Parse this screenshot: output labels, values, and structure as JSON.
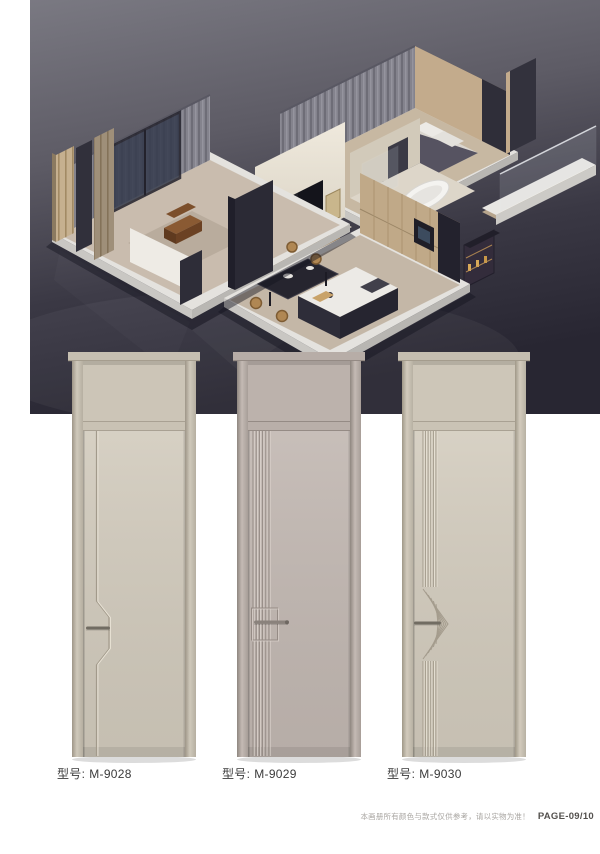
{
  "hero": {
    "description": "isometric 3d cutaway render of an apartment interior on dark backdrop",
    "background_top": "#77767f",
    "background_bottom": "#262430",
    "platform_color": "#e4e2de",
    "accent_wood": "#c3ab8c",
    "accent_dark_wall": "#2d2c37"
  },
  "products": [
    {
      "label_prefix": "型号:",
      "model": "M-9028",
      "door_color": "#d2cbbd",
      "design": "single-groove-jog-handle"
    },
    {
      "label_prefix": "型号:",
      "model": "M-9029",
      "door_color": "#c2b8b2",
      "design": "fluted-strip-handle-plate"
    },
    {
      "label_prefix": "型号:",
      "model": "M-9030",
      "door_color": "#d3ccbe",
      "design": "fluted-strip-chevron-fan"
    }
  ],
  "footer": {
    "disclaimer": "本画册所有颜色与款式仅供参考，请以实物为准！",
    "page_label": "PAGE-09/10"
  }
}
